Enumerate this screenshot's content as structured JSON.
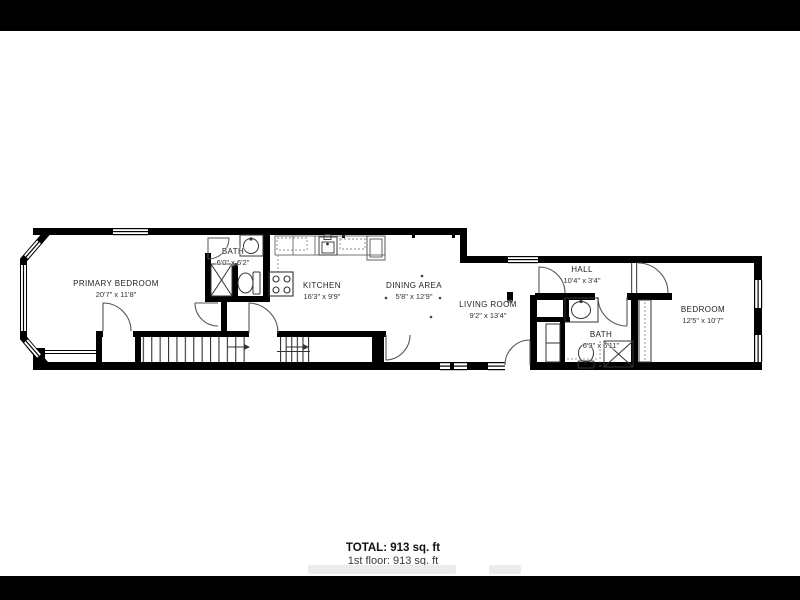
{
  "plan": {
    "type": "floor-plan",
    "letterbox_color": "#000000",
    "background_color": "#ffffff",
    "wall_color": "#000000",
    "line_color": "#333333",
    "text_color": "#222222"
  },
  "rooms": [
    {
      "name": "PRIMARY BEDROOM",
      "dims": "20'7\" x 11'8\""
    },
    {
      "name": "BATH",
      "dims": "6'0\" x 6'2\""
    },
    {
      "name": "KITCHEN",
      "dims": "16'3\" x 9'9\""
    },
    {
      "name": "DINING AREA",
      "dims": "5'8\" x 12'9\""
    },
    {
      "name": "LIVING ROOM",
      "dims": "9'2\" x 13'4\""
    },
    {
      "name": "HALL",
      "dims": "10'4\" x 3'4\""
    },
    {
      "name": "BATH",
      "dims": "6'3\" x 6'11\""
    },
    {
      "name": "BEDROOM",
      "dims": "12'5\" x 10'7\""
    }
  ],
  "summary": {
    "total": "TOTAL: 913 sq. ft",
    "floor": "1st floor: 913 sq. ft"
  }
}
